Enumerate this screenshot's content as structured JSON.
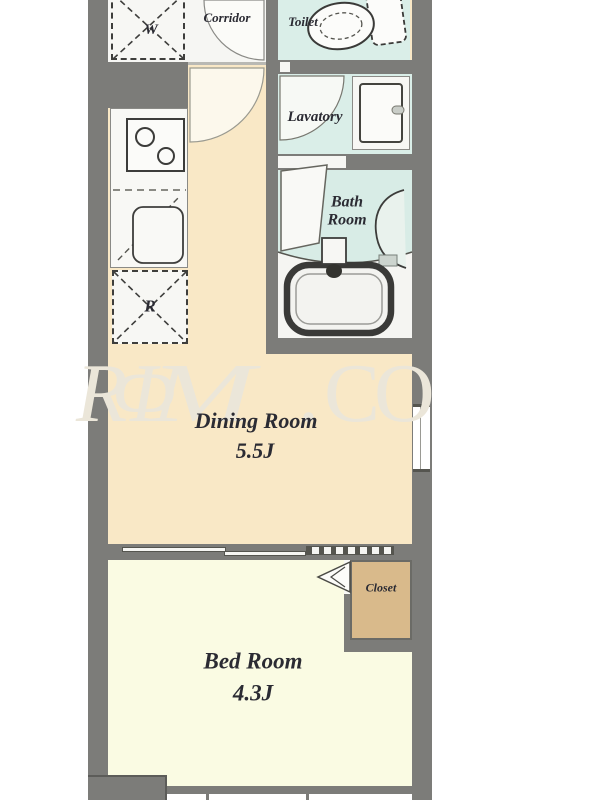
{
  "watermark": {
    "letters": {
      "l1": "R",
      "l2": "Φ",
      "l3": "M",
      "l4": ".",
      "l5": "C",
      "l6": "O"
    }
  },
  "rooms": {
    "washer_space": {
      "label": "W"
    },
    "corridor": {
      "label": "Corridor"
    },
    "toilet": {
      "label": "Toilet"
    },
    "lavatory": {
      "label": "Lavatory"
    },
    "bathroom": {
      "label_line1": "Bath",
      "label_line2": "Room"
    },
    "refrigerator_space": {
      "label": "R"
    },
    "dining": {
      "name": "Dining Room",
      "size": "5.5J"
    },
    "closet": {
      "label": "Closet"
    },
    "bedroom": {
      "name": "Bed Room",
      "size": "4.3J"
    }
  },
  "colors": {
    "wall": "#7c7c79",
    "dining_floor": "#f9e8c6",
    "bedroom_floor": "#fafbe3",
    "closet_floor": "#d9ba8b",
    "wet_area_floor": "#daeee8",
    "white_floor": "#f6f6f3",
    "label_text": "#2b2b33",
    "watermark_text": "#ebe6d9",
    "fixture_outline": "#3a3a38"
  }
}
